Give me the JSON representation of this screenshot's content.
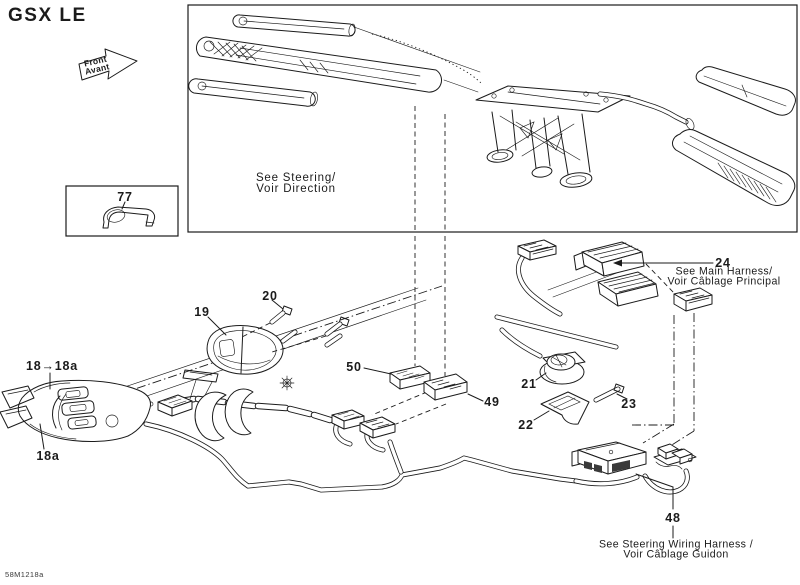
{
  "title": "GSX LE",
  "doc_number": "58M1218a",
  "front_arrow": {
    "line1": "Front",
    "line2": "Avant"
  },
  "inset_note": {
    "line1": "See Steering/",
    "line2": "Voir Direction"
  },
  "callouts": {
    "c18_pair": "18→18a",
    "c18a": "18a",
    "c19": "19",
    "c20": "20",
    "c21": "21",
    "c22": "22",
    "c23": "23",
    "c24": "24",
    "c48": "48",
    "c49": "49",
    "c50": "50",
    "c77": "77"
  },
  "notes": {
    "main_harness_line1": "See Main Harness/",
    "main_harness_line2": "Voir Câblage Principal",
    "steering_harness_line1": "See Steering Wiring Harness /",
    "steering_harness_line2": "Voir Câblage Guidon"
  }
}
